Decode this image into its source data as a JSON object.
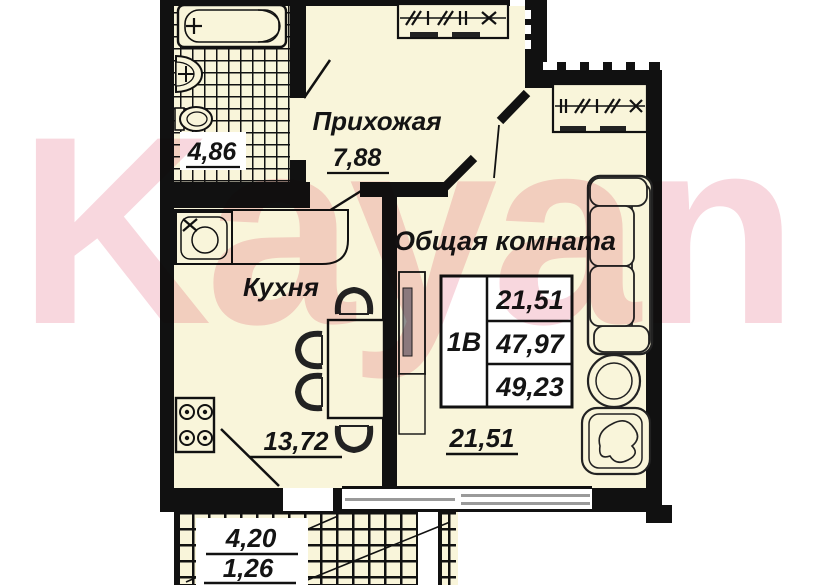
{
  "watermark": {
    "text": "Kayan"
  },
  "colors": {
    "floor": "#f9f5da",
    "wall": "#111111",
    "watermark_pink": "#f8d7de",
    "window_gray": "#9a9a9a"
  },
  "rooms": {
    "hallway": {
      "name": "Прихожая",
      "area": "7,88"
    },
    "bathroom": {
      "area": "4,86"
    },
    "kitchen": {
      "name": "Кухня",
      "area": "13,72"
    },
    "living_room": {
      "name": "Общая комната",
      "area": "21,51"
    },
    "balcony": {
      "area_full": "4,20",
      "area_reduced": "1,26"
    }
  },
  "info_table": {
    "flat_type": "1В",
    "rows": [
      "21,51",
      "47,97",
      "49,23"
    ]
  },
  "fixtures": [
    "bathtub",
    "wash-basin",
    "toilet",
    "kitchen-sink",
    "stove",
    "dining-table",
    "chair",
    "wardrobe",
    "sofa",
    "round-table",
    "armchair",
    "tv-stand",
    "window",
    "door",
    "balcony"
  ]
}
